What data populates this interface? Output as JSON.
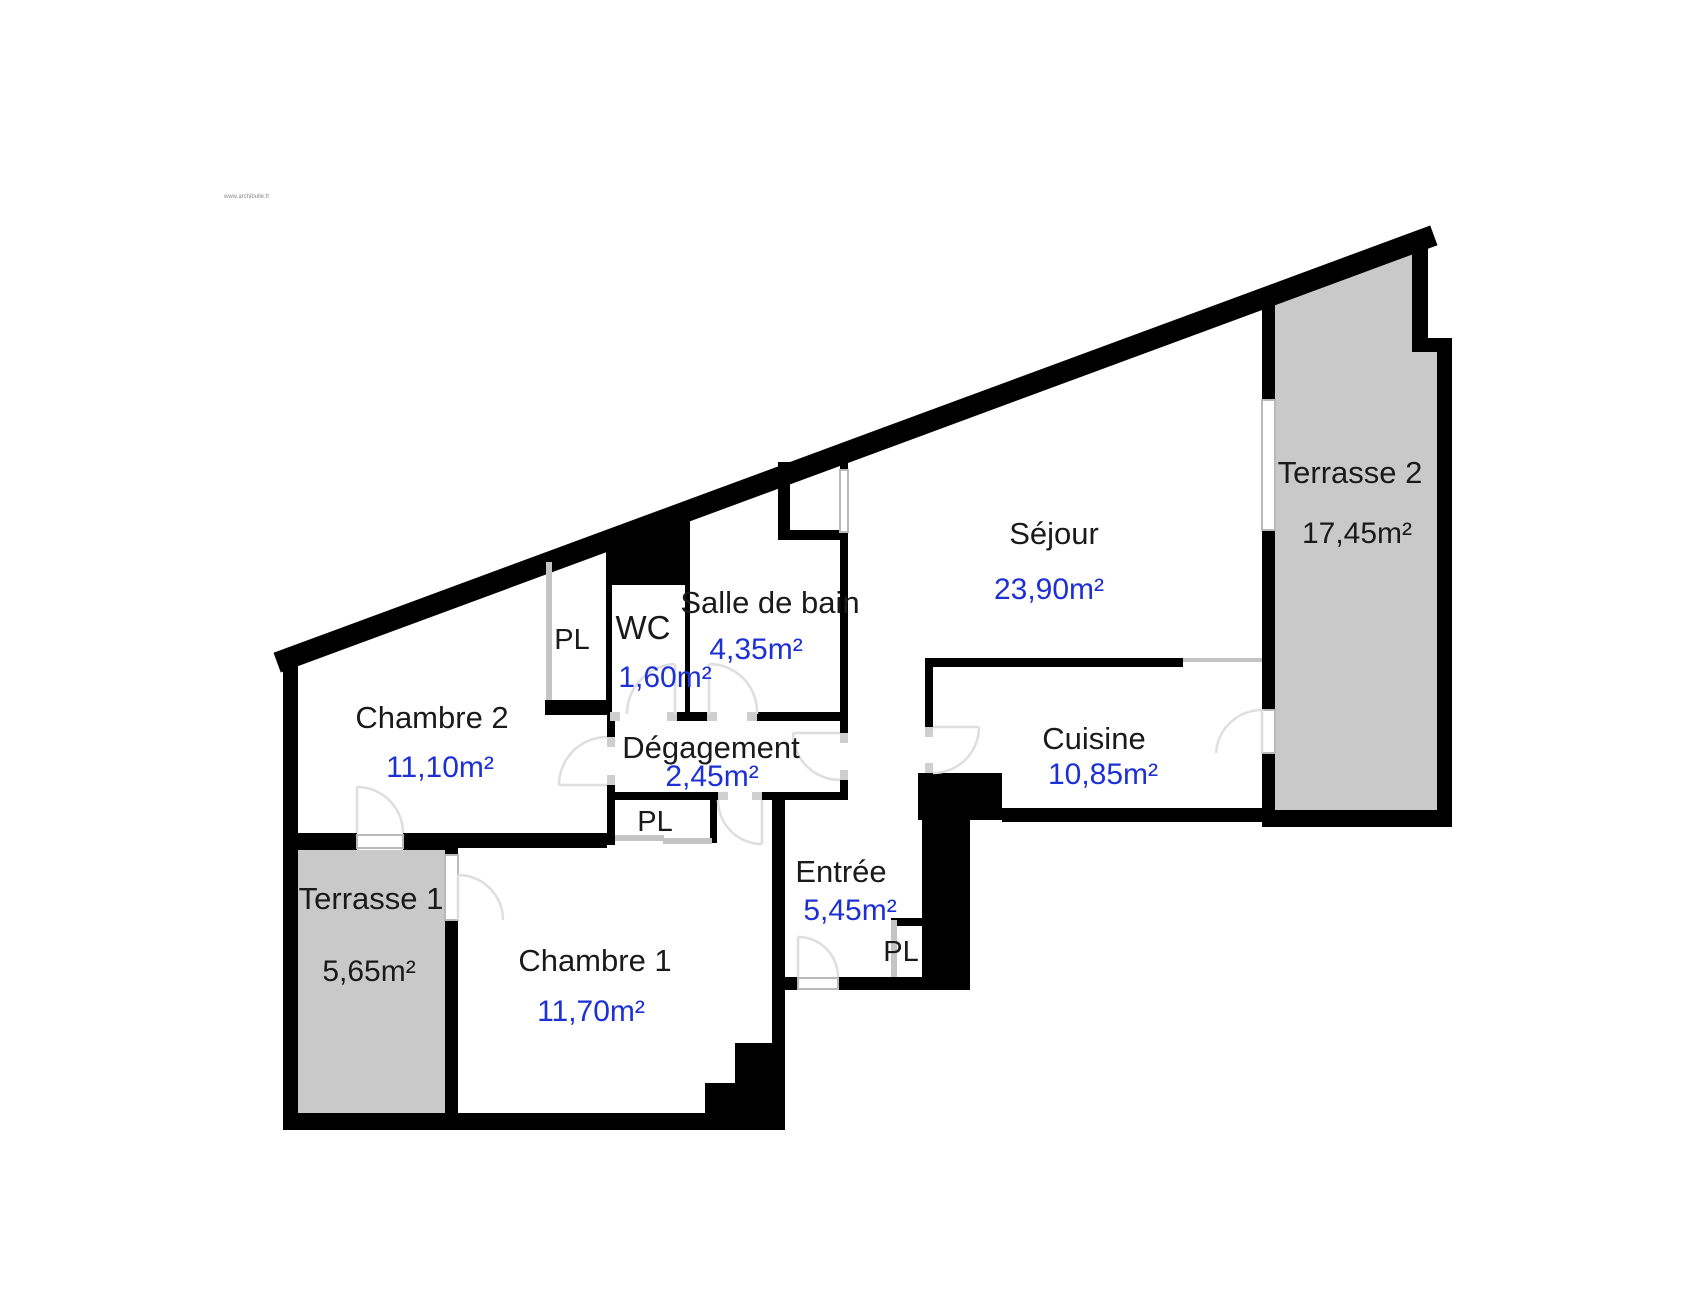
{
  "watermark": "www.archibulle.fr",
  "rooms": {
    "sejour": {
      "name": "Séjour",
      "area": "23,90m²"
    },
    "cuisine": {
      "name": "Cuisine",
      "area": "10,85m²"
    },
    "salle_de_bain": {
      "name": "Salle de bain",
      "area": "4,35m²"
    },
    "wc": {
      "name": "WC",
      "area": "1,60m²"
    },
    "degagement": {
      "name": "Dégagement",
      "area": "2,45m²"
    },
    "entree": {
      "name": "Entrée",
      "area": "5,45m²"
    },
    "chambre1": {
      "name": "Chambre 1",
      "area": "11,70m²"
    },
    "chambre2": {
      "name": "Chambre 2",
      "area": "11,10m²"
    },
    "terrasse1": {
      "name": "Terrasse 1",
      "area": "5,65m²"
    },
    "terrasse2": {
      "name": "Terrasse 2",
      "area": "17,45m²"
    }
  },
  "closets": {
    "hall_top": "PL",
    "hall_bottom": "PL",
    "entree": "PL"
  },
  "colors": {
    "wall": "#000000",
    "terrace_fill": "#c9c9c9",
    "area_text": "#1c30d6",
    "label_text": "#1a1a1a",
    "window": "#b9b9b9",
    "door_arc": "#dedede"
  }
}
